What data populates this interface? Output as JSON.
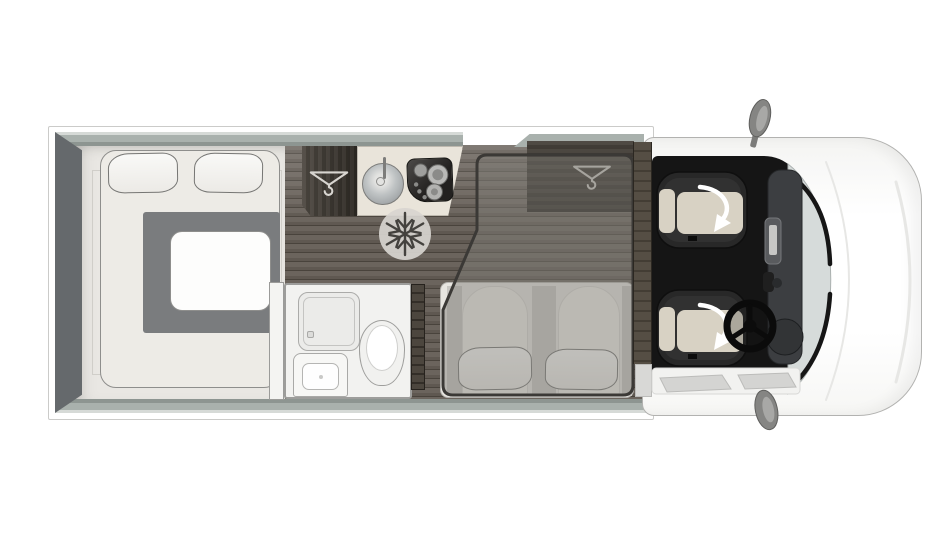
{
  "colors": {
    "wall_sage": "#a9b1ad",
    "wall_dark": "#65696c",
    "floor_bedroom": "#e9e7e3",
    "floor_wood": "#5f5851",
    "bed_cream": "#edebe6",
    "duvet_gray": "#7a7c7e",
    "pillow_white": "#f9f9f7",
    "furniture_wood_dark": "#423c35",
    "counter_cream": "#e9e4da",
    "steel_gray": "#a7abad",
    "bathroom_white": "#f2f2f0",
    "overlay_gray": "#807d78",
    "overlay_outline": "#3b3936",
    "bench_cream": "#e7e5e0",
    "cab_floor_black": "#151515",
    "seat_dark": "#282828",
    "seat_cushion_beige": "#d8d2c4",
    "dashboard_gray": "#3c3e41",
    "windshield_gray": "#d6dbda",
    "vehicle_body_white": "#fbfbfa",
    "mirror_gray": "#858583",
    "arrow_white": "#ffffff",
    "icon_light": "#d8d5d0",
    "icon_dark": "#44423e"
  },
  "rooms": {
    "bedroom": {
      "items": [
        "double-bed",
        "pillow",
        "pillow",
        "duvet"
      ]
    },
    "kitchen": {
      "items": [
        "wardrobe-with-hanger",
        "round-sink",
        "hob-3-burner",
        "fridge-snowflake"
      ]
    },
    "bathroom": {
      "items": [
        "shower-tray",
        "washbasin",
        "toilet"
      ]
    },
    "lounge": {
      "items": [
        "bench-seat",
        "pillow",
        "pillow",
        "drop-down-bed-overlay",
        "overhead-wardrobe-with-hanger"
      ]
    },
    "cab": {
      "items": [
        "swivel-passenger-seat",
        "swivel-driver-seat",
        "steering-wheel",
        "dashboard",
        "windscreen",
        "wing-mirror",
        "wing-mirror",
        "entry-step"
      ]
    }
  },
  "icons": {
    "hanger": "clothes-hanger-icon",
    "snowflake": "freezer-snowflake-icon",
    "swivel_arrow": "seat-swivel-arrow-icon"
  }
}
